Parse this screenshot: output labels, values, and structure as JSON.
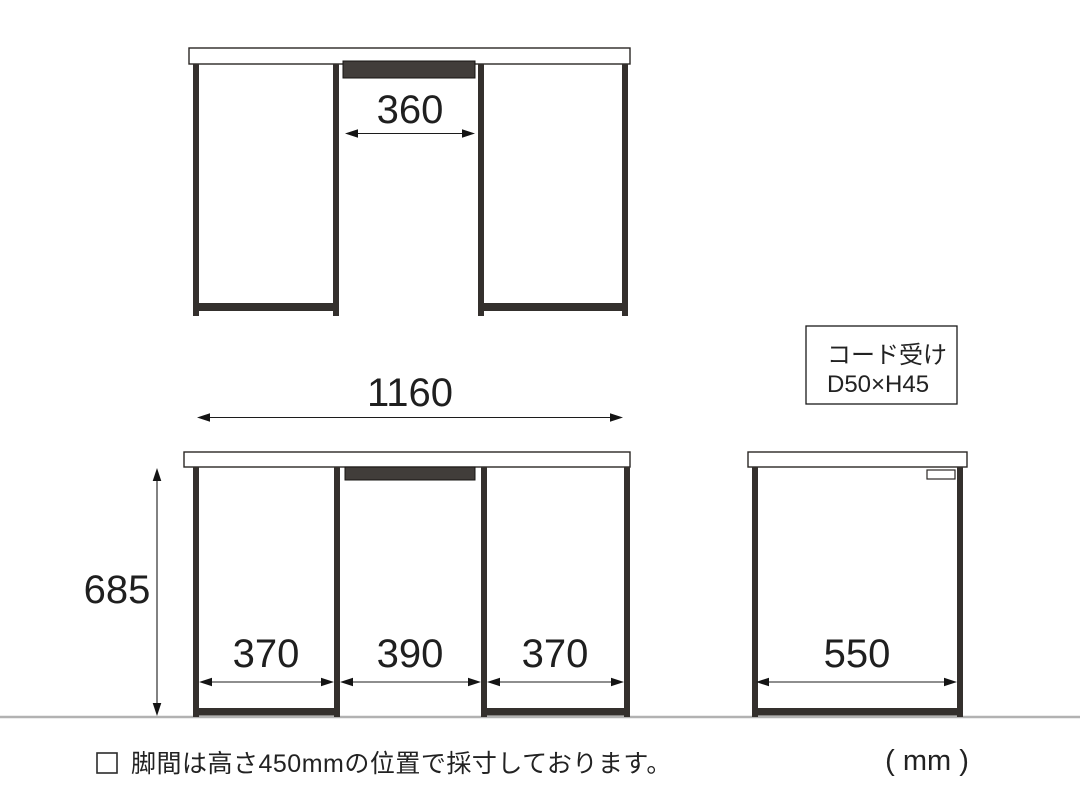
{
  "views": {
    "back": {
      "cord_width": "360"
    },
    "front": {
      "total_width": "1160",
      "height": "685",
      "left_leg_span": "370",
      "center_span": "390",
      "right_leg_span": "370"
    },
    "side": {
      "depth": "550"
    }
  },
  "cord_label": {
    "line1": "コード受け",
    "line2": "D50×H45"
  },
  "footnote": {
    "bullet": "□",
    "text": "脚間は高さ450mmの位置で採寸しております。"
  },
  "unit": "( mm )",
  "colors": {
    "frame": "#34302d",
    "cord_tray": "#413d3a",
    "dimension_line": "#1c1c1c",
    "ground_line": "#b2b2b2",
    "text": "#222222"
  }
}
